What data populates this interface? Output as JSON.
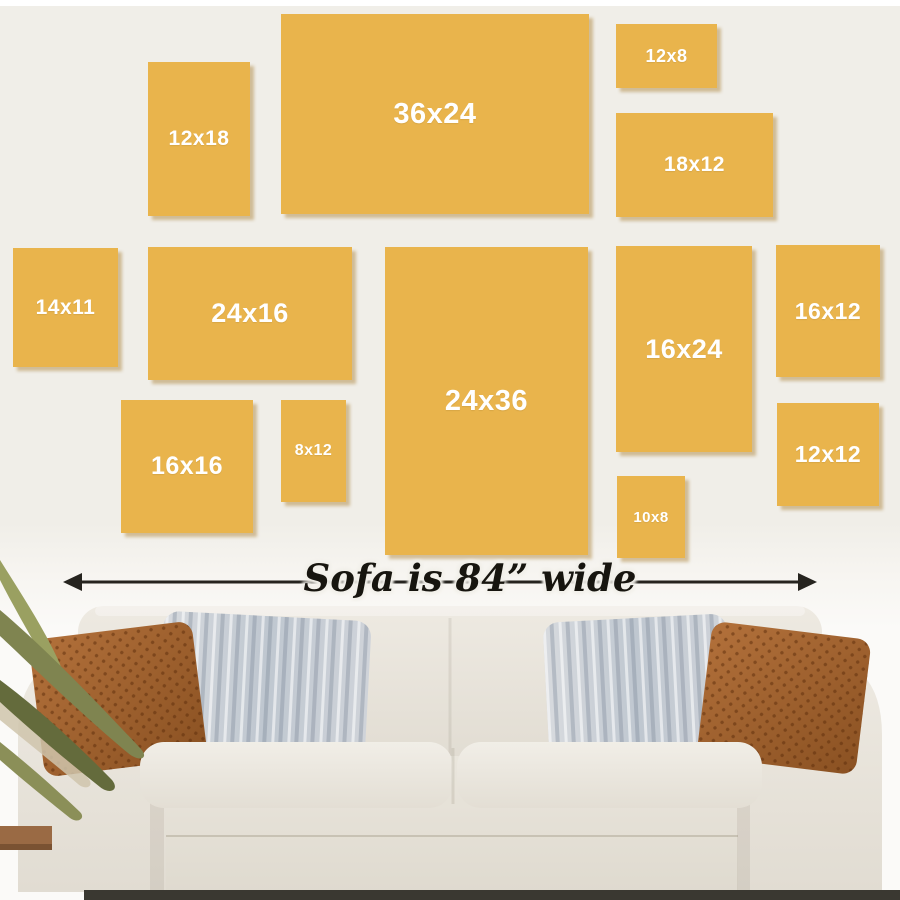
{
  "scene": {
    "description": "Canvas print size guide displayed on a wall above a sofa",
    "wall_color_top": "#f0eee8",
    "wall_color_bottom": "#fbfaf8",
    "frame_color": "#e9b44c",
    "frame_label_color": "#ffffff",
    "arrow_color": "#26241f"
  },
  "frames": [
    {
      "label": "12x18",
      "x": 148,
      "y": 62,
      "w": 102,
      "h": 154,
      "fs": 21
    },
    {
      "label": "36x24",
      "x": 281,
      "y": 14,
      "w": 308,
      "h": 200,
      "fs": 29
    },
    {
      "label": "12x8",
      "x": 616,
      "y": 24,
      "w": 101,
      "h": 64,
      "fs": 18
    },
    {
      "label": "18x12",
      "x": 616,
      "y": 113,
      "w": 157,
      "h": 104,
      "fs": 21
    },
    {
      "label": "14x11",
      "x": 13,
      "y": 248,
      "w": 105,
      "h": 119,
      "fs": 21
    },
    {
      "label": "24x16",
      "x": 148,
      "y": 247,
      "w": 204,
      "h": 133,
      "fs": 27
    },
    {
      "label": "24x36",
      "x": 385,
      "y": 247,
      "w": 203,
      "h": 308,
      "fs": 29
    },
    {
      "label": "16x24",
      "x": 616,
      "y": 246,
      "w": 136,
      "h": 206,
      "fs": 27
    },
    {
      "label": "16x12",
      "x": 776,
      "y": 245,
      "w": 104,
      "h": 132,
      "fs": 23
    },
    {
      "label": "16x16",
      "x": 121,
      "y": 400,
      "w": 132,
      "h": 133,
      "fs": 25
    },
    {
      "label": "8x12",
      "x": 281,
      "y": 400,
      "w": 65,
      "h": 102,
      "fs": 16
    },
    {
      "label": "10x8",
      "x": 617,
      "y": 476,
      "w": 68,
      "h": 82,
      "fs": 15
    },
    {
      "label": "12x12",
      "x": 777,
      "y": 403,
      "w": 102,
      "h": 103,
      "fs": 23
    }
  ],
  "arrow": {
    "label": "Sofa is 84” wide",
    "x1": 63,
    "x2": 817,
    "y": 582
  }
}
